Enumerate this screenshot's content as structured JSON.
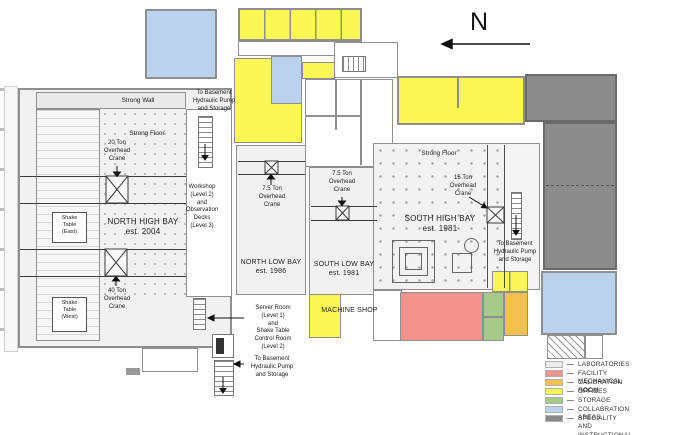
{
  "north_indicator": {
    "label": "N"
  },
  "bays": {
    "north_high_bay": "NORTH HIGH BAY\nest. 2004",
    "south_high_bay": "SOUTH HIGH BAY\nest. 1981",
    "north_low_bay": "NORTH LOW BAY\nest. 1986",
    "south_low_bay": "SOUTH LOW BAY\nest. 1981",
    "machine_shop": "MACHINE SHOP"
  },
  "features": {
    "strong_wall": "Strong Wall",
    "strong_floor_north": "Strong Floor",
    "strong_floor_south": "Strong Floor",
    "shake_table_east": "Shake\nTable\n(East)",
    "shake_table_west": "Shake\nTable\n(West)",
    "crane_20t": "20 Ton\nOverhead\nCrane",
    "crane_40t": "40 Ton\nOverhead\nCrane",
    "crane_7_5t_north": "7.5 Ton\nOverhead\nCrane",
    "crane_7_5t_south": "7.5 Ton\nOverhead\nCrane",
    "crane_15t": "15 Ton\nOverhead\nCrane",
    "workshop": "Workshop\n(Level 2)\nand\nObservation\nDecks\n(Level 3)",
    "server_room": "Server Room\n(Level 1)\nand\nShake Table\nControl Room\n(Level 2)",
    "to_basement_nw": "To Basement\nHydraulic Pump\nand Storage",
    "to_basement_sw": "To Basement\nHydraulic Pump\nand Storage",
    "to_basement_se": "To Basement\nHydraulic Pump\nand Storage"
  },
  "colors": {
    "laboratories": "#f1f1f1",
    "mechanical": "#f4938e",
    "calibration": "#f5c14e",
    "offices": "#fbf854",
    "storage": "#a6cb89",
    "collaboration": "#bad2eb",
    "speciality": "#8c8c8c"
  },
  "legend": {
    "items": [
      {
        "label": "LABORATORIES",
        "color": "#ececec"
      },
      {
        "label": "FACILITY MECHANICAL ROOM",
        "color": "#f4938e"
      },
      {
        "label": "CALIBRATION ROOM",
        "color": "#f5c14e"
      },
      {
        "label": "OFFICES",
        "color": "#fbf854"
      },
      {
        "label": "STORAGE",
        "color": "#a6cb89"
      },
      {
        "label": "COLLABRATION AREAS",
        "color": "#bad2eb"
      },
      {
        "label": "SPECIALITY AND INSTRUCTIONAL\nLABORATORIES",
        "color": "#8a8a8a"
      }
    ]
  }
}
